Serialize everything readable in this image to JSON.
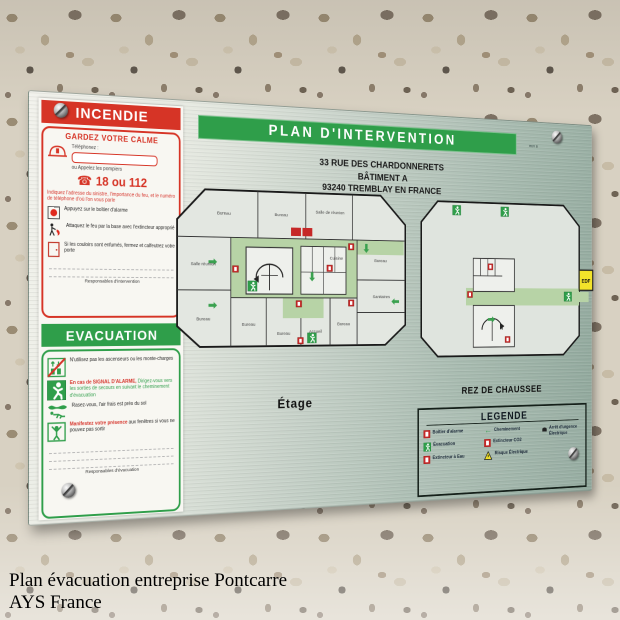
{
  "caption": {
    "line1": "Plan évacuation entreprise Pontcarre",
    "line2": "AYS France"
  },
  "plate": {
    "title": "PLAN D'INTERVENTION",
    "revision": "REV B",
    "address_line1": "33 RUE DES CHARDONNERETS",
    "address_line2": "BÂTIMENT A",
    "address_line3": "93240 TREMBLAY EN FRANCE",
    "incendie": {
      "header": "INCENDIE",
      "subheader": "GARDEZ VOTRE CALME",
      "phone_label": "Téléphonez :",
      "call_label": "ou Appelez les pompiers",
      "numbers": "18 ou 112",
      "notice": "Indiquez l'adresse du sinistre, l'importance du feu, et le numéro de téléphone d'où l'on vous parle",
      "steps": [
        {
          "text": "Appuyez sur le boîtier d'alarme"
        },
        {
          "text": "Attaquez le feu par la base avec l'extincteur approprié"
        },
        {
          "text": "Si les couloirs sont enfumés, fermez et calfeutrez votre porte"
        }
      ],
      "footer": "Responsables d'intervention"
    },
    "evacuation": {
      "header": "EVACUATION",
      "step1": "N'utilisez pas les ascenseurs ou les monte-charges",
      "step2_red": "En cas de SIGNAL D'ALARME,",
      "step2": "Dirigez-vous vers les sorties de secours en suivant le cheminement d'évacuation",
      "step3": "Rasez-vous, l'air frais est près du sol",
      "step4_red": "Manifestez votre présence",
      "step4": "aux fenêtres si vous ne pouvez pas sortir",
      "footer": "Responsables d'évacuation"
    },
    "floor1": {
      "label": "Étage",
      "rooms": [
        "Bureau",
        "Bureau",
        "Salle de réunion",
        "Bureau",
        "Salle réunion",
        "Bureau",
        "Bureau",
        "Bureau",
        "Accueil",
        "Bureau",
        "Sanitaires",
        "Cuisine"
      ]
    },
    "floor0": {
      "label": "REZ DE CHAUSSEE",
      "edf": "EDF"
    },
    "legend": {
      "title": "LEGENDE",
      "items": [
        {
          "icon": "alarm-box-icon",
          "label": "Boîtier d'alarme"
        },
        {
          "icon": "evacuation-icon",
          "label": "Évacuation"
        },
        {
          "icon": "water-extinguisher-icon",
          "label": "Extincteur à Eau"
        },
        {
          "icon": "path-arrow-icon",
          "label": "Cheminement"
        },
        {
          "icon": "co2-extinguisher-icon",
          "label": "Extincteur CO2"
        },
        {
          "icon": "electric-risk-icon",
          "label": "Risque Électrique"
        },
        {
          "icon": "emergency-stop-icon",
          "label": "Arrêt d'urgence Électrique"
        }
      ]
    },
    "colors": {
      "green": "#2f9e4a",
      "red": "#d63426",
      "corridor": "#b7d3a6",
      "edf_yellow": "#f2e32a"
    }
  }
}
